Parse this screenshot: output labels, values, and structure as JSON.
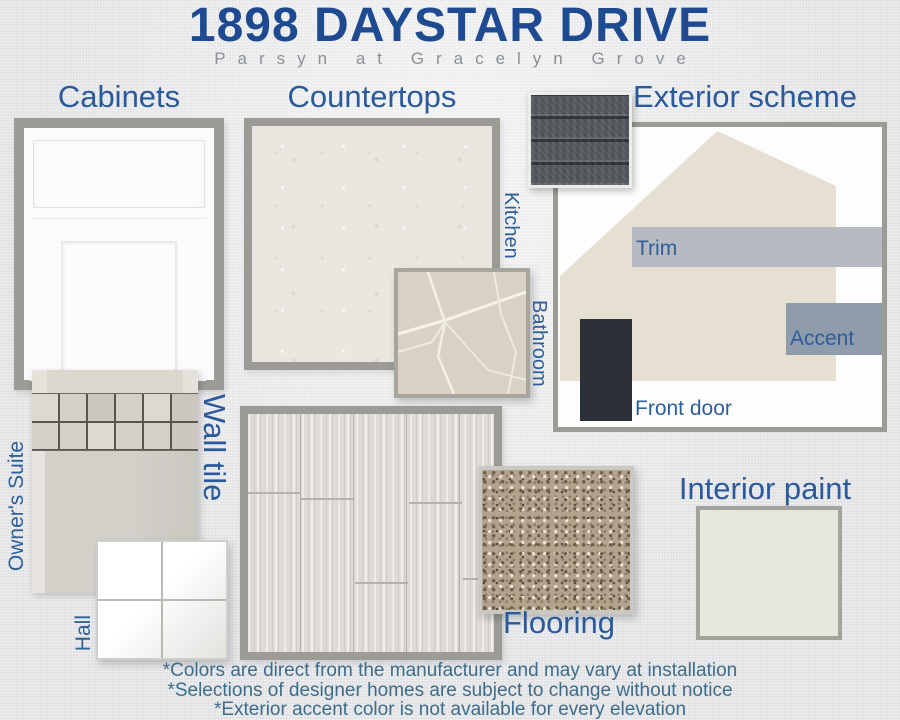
{
  "page": {
    "title": "1898 DAYSTAR DRIVE",
    "subtitle": "Parsyn at Gracelyn Grove"
  },
  "sections": {
    "cabinets": {
      "heading": "Cabinets"
    },
    "countertops": {
      "heading": "Countertops",
      "kitchen_label": "Kitchen",
      "bathroom_label": "Bathroom"
    },
    "exterior": {
      "heading": "Exterior scheme",
      "trim_label": "Trim",
      "accent_label": "Accent",
      "front_door_label": "Front door"
    },
    "wall_tile": {
      "heading": "Wall tile",
      "owners_suite_label": "Owner's Suite",
      "hall_label": "Hall"
    },
    "flooring": {
      "heading": "Flooring"
    },
    "interior_paint": {
      "heading": "Interior paint"
    }
  },
  "footnotes": [
    "*Colors are direct from the manufacturer and may vary at installation",
    "*Selections of designer homes are subject to change without notice",
    "*Exterior accent color is not available for every elevation"
  ],
  "colors": {
    "title_navy": "#1d4a90",
    "heading_blue": "#2a5a9b",
    "label_blue": "#2e5f98",
    "subtitle_gray": "#8b9095",
    "footnote_blue": "#3e6c8b",
    "frame_gray": "#9c9b95",
    "house_body": "#e6e0d3",
    "trim_swatch": "#b5bbc1",
    "accent_swatch": "#8e9cab",
    "front_door_swatch": "#2b3137",
    "interior_paint_swatch": "#e7e7df",
    "shingle_dark": "#4d5358"
  }
}
